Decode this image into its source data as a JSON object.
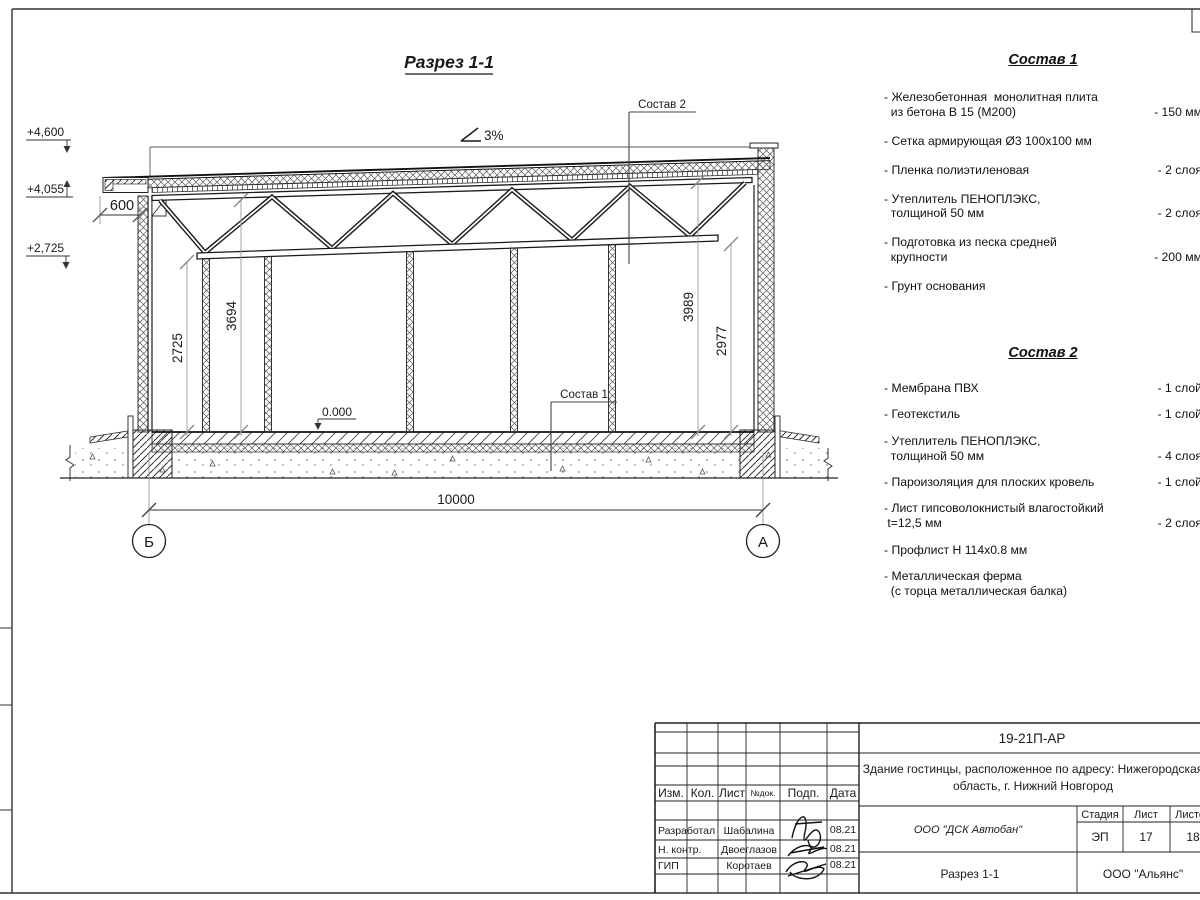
{
  "colors": {
    "ink": "#1a1a1a",
    "aux": "#999999",
    "paper": "#ffffff"
  },
  "drawing": {
    "title": "Разрез 1-1",
    "slope_label": "3%",
    "elev_top": "+4,600",
    "elev_mid": "+4,055",
    "elev_low": "+2,725",
    "dim_overhang": "600",
    "dim_span": "10000",
    "dim_left_bottom": "2725",
    "dim_left_top": "3694",
    "dim_right_top": "3989",
    "dim_right_bottom": "2977",
    "level_zero": "0.000",
    "axis_left": "Б",
    "axis_right": "А",
    "callout_1": "Состав 1",
    "callout_2": "Состав 2"
  },
  "spec1": {
    "title": "Состав 1",
    "items": [
      {
        "text": "- Железобетонная  монолитная плита\n  из бетона В 15 (М200)",
        "value": "- 150 мм"
      },
      {
        "text": "- Сетка армирующая Ø3 100х100 мм",
        "value": ""
      },
      {
        "text": "- Пленка полиэтиленовая",
        "value": "-  2 слоя"
      },
      {
        "text": "- Утеплитель ПЕНОПЛЭКС,\n  толщиной 50 мм",
        "value": "- 2 слоя"
      },
      {
        "text": "- Подготовка из песка средней\n  крупности",
        "value": "- 200 мм"
      },
      {
        "text": "- Грунт основания",
        "value": ""
      }
    ]
  },
  "spec2": {
    "title": "Состав 2",
    "items": [
      {
        "text": "- Мембрана ПВХ",
        "value": "- 1 слой"
      },
      {
        "text": "- Геотекстиль",
        "value": "- 1 слой"
      },
      {
        "text": "- Утеплитель ПЕНОПЛЭКС,\n  толщиной 50 мм",
        "value": "- 4 слоя"
      },
      {
        "text": "- Пароизоляция для плоских кровель",
        "value": "- 1 слой"
      },
      {
        "text": "- Лист гипсоволокнистый влагостойкий\n t=12,5 мм",
        "value": "- 2 слоя"
      },
      {
        "text": "- Профлист Н 114х0.8 мм",
        "value": ""
      },
      {
        "text": "- Металлическая ферма\n  (с торца металлическая балка)",
        "value": ""
      }
    ]
  },
  "titleblock": {
    "doc_number": "19-21П-АР",
    "project_line1": "Здание гостинцы, расположенное по адресу: Нижегородская",
    "project_line2": "область, г. Нижний Новгород",
    "col_izm": "Изм.",
    "col_kol": "Кол.",
    "col_list": "Лист",
    "col_ndok": "№док.",
    "col_podp": "Подп.",
    "col_data": "Дата",
    "row1_role": "Разработал",
    "row1_name": "Шабалина",
    "row1_date": "08.21",
    "row2_role": "Н. контр.",
    "row2_name": "Двоеглазов",
    "row2_date": "08.21",
    "row3_role": "ГИП",
    "row3_name": "Коротаев",
    "row3_date": "08.21",
    "company": "ООО \"ДСК Автобан\"",
    "stage_label": "Стадия",
    "sheet_label": "Лист",
    "sheets_label": "Листов",
    "stage": "ЭП",
    "sheet": "17",
    "sheets": "18",
    "drawing_name": "Разрез 1-1",
    "org": "ООО \"Альянс\""
  }
}
